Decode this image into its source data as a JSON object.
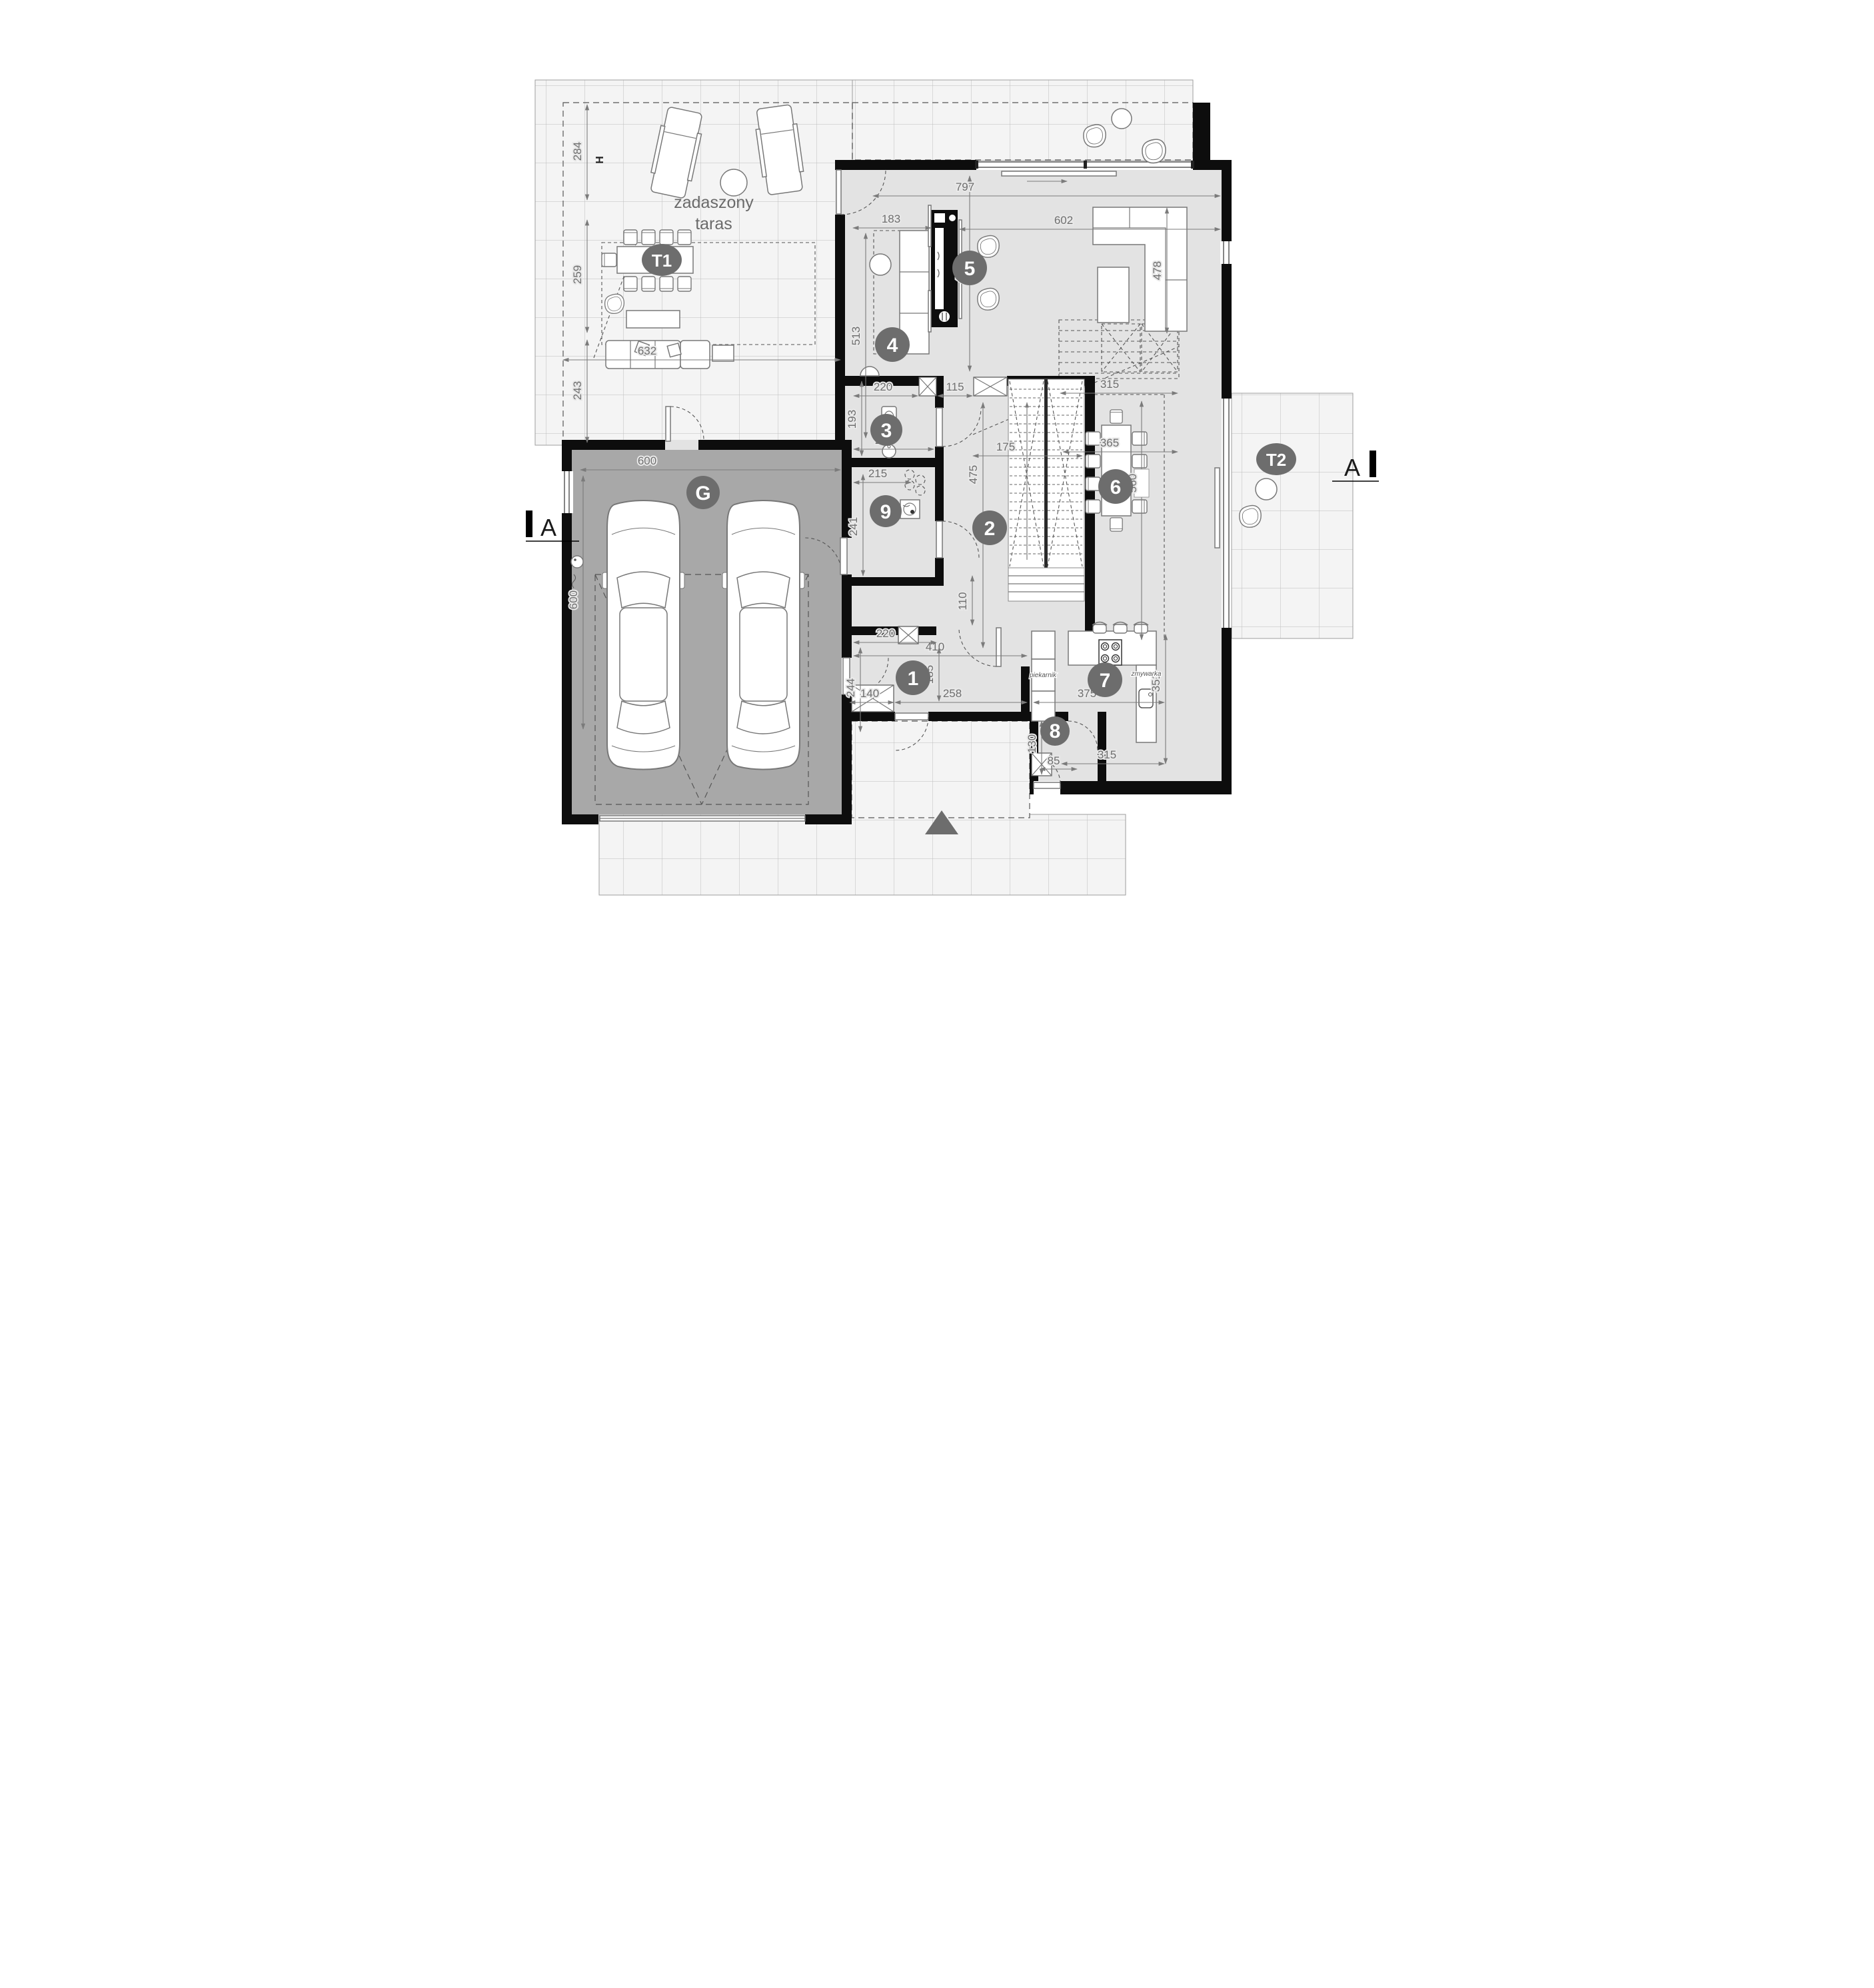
{
  "labels": {
    "terrace_covered_1": "zadaszony",
    "terrace_covered_2": "taras",
    "oven": "piekarnik",
    "dishwasher": "zmywarka",
    "hose_bib": "H"
  },
  "badges": {
    "room1": "1",
    "room2": "2",
    "room3": "3",
    "room4": "4",
    "room5": "5",
    "room6": "6",
    "room7": "7",
    "room8": "8",
    "room9": "9",
    "garage": "G",
    "terrace1": "T1",
    "terrace2": "T2"
  },
  "sections": {
    "left": "A",
    "right": "A"
  },
  "dims": {
    "d284": "284",
    "d259": "259",
    "d243": "243",
    "d632": "632",
    "d600w": "600",
    "d600h": "600",
    "d183": "183",
    "d513": "513",
    "d453": "453",
    "d797": "797",
    "d602": "602",
    "d478": "478",
    "d115": "115",
    "d315a": "315",
    "d175": "175",
    "d475": "475",
    "d110": "110",
    "d193": "193",
    "d220a": "220",
    "d220b": "220",
    "d215": "215",
    "d241": "241",
    "d365": "365",
    "d560": "560",
    "d375": "375",
    "d351": "351",
    "d315b": "315",
    "d410": "410",
    "d244": "244",
    "d185": "185",
    "d258": "258",
    "d140": "140",
    "d220c": "220",
    "d130": "130",
    "d85": "85"
  }
}
